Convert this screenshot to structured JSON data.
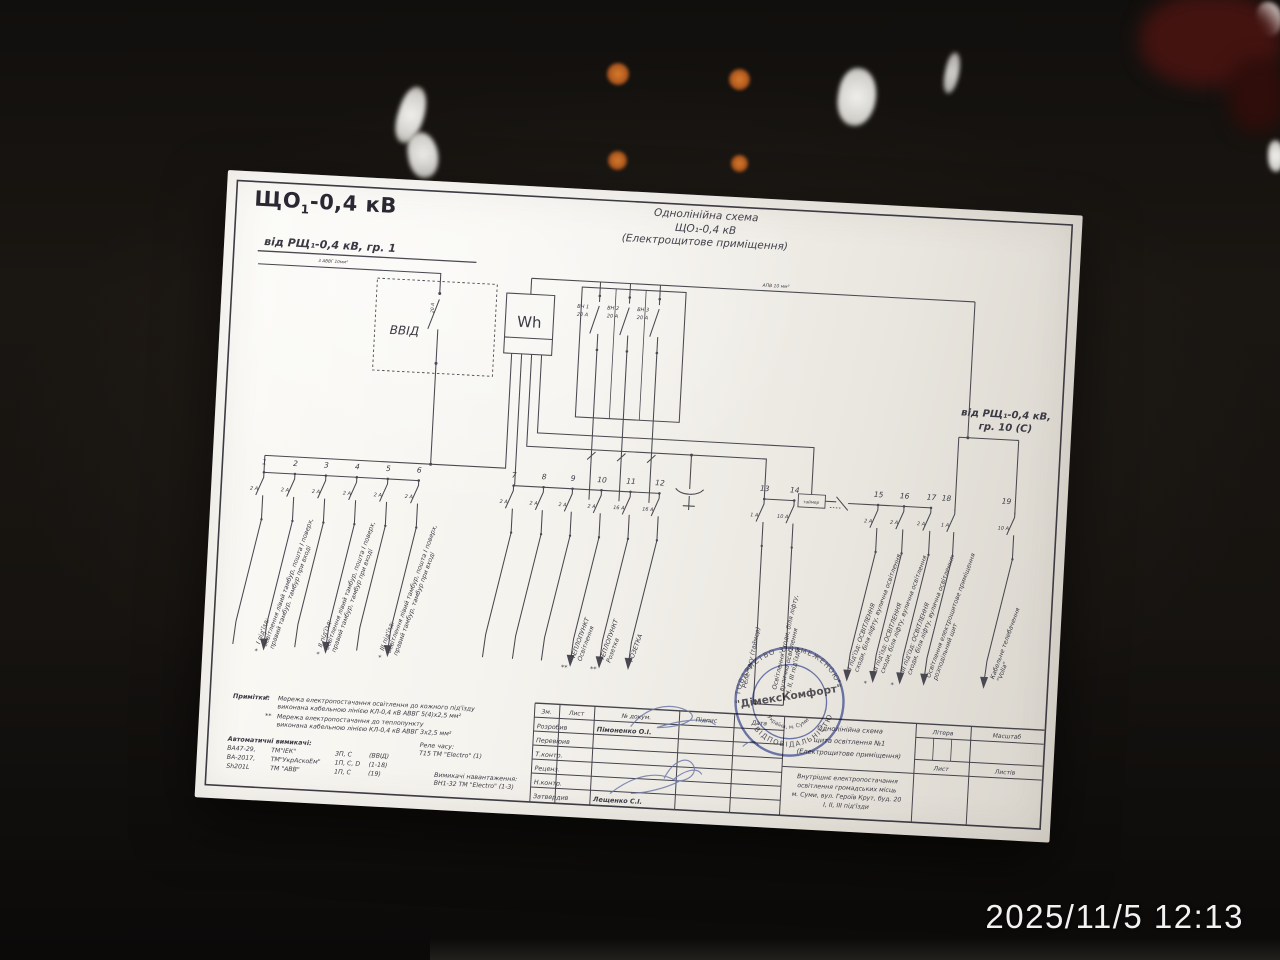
{
  "photo": {
    "timestamp": "2025/11/5 12:13"
  },
  "doc": {
    "board_title": {
      "prefix": "ЩО",
      "sub": "1",
      "suffix": "-0,4 кВ"
    },
    "scheme_title": [
      "Однолінійна схема",
      "ЩО₁-0,4 кВ",
      "(Електрощитове приміщення)"
    ],
    "feed_left": {
      "label": "від РЩ₁-0,4 кВ, гр. 1",
      "cable": "3 АВВГ 10мм²"
    },
    "feed_right": [
      "від РЩ₁-0,4 кВ,",
      "гр. 10 (С)"
    ],
    "vvid": {
      "label": "ВВІД",
      "rating": "20 А"
    },
    "meter": "Wh",
    "bus_note": "АПВ 10 мм²",
    "relay_box": "таймер",
    "vn": [
      {
        "name": "ВН 1",
        "amp": "20 А"
      },
      {
        "name": "ВН 2",
        "amp": "20 А"
      },
      {
        "name": "ВН 3",
        "amp": "20 А"
      }
    ],
    "circuits": [
      {
        "n": "1",
        "amp": "2 А",
        "label": "",
        "marker": ""
      },
      {
        "n": "2",
        "amp": "2 А",
        "label": "І під'їзд:\nосвітлення лівий тамбур, пошта І поверх,\nправий тамбур, тамбур при вході",
        "marker": "*"
      },
      {
        "n": "3",
        "amp": "2 А",
        "label": "",
        "marker": ""
      },
      {
        "n": "4",
        "amp": "2 А",
        "label": "ІІ під'їзд:\nосвітлення лівий тамбур, пошта І поверх,\nправий тамбур, тамбур при вході",
        "marker": "*"
      },
      {
        "n": "5",
        "amp": "2 А",
        "label": "",
        "marker": ""
      },
      {
        "n": "6",
        "amp": "2 А",
        "label": "ІІІ під'їзд:\nосвітлення лівий тамбур, пошта І поверх,\nправий тамбур, тамбур при вході",
        "marker": "*"
      },
      {
        "n": "7",
        "amp": "2 А",
        "label": "",
        "marker": ""
      },
      {
        "n": "8",
        "amp": "2 А",
        "label": "",
        "marker": ""
      },
      {
        "n": "9",
        "amp": "2 А",
        "label": "",
        "marker": ""
      },
      {
        "n": "10",
        "amp": "2 А",
        "label": "ТЕПЛОПУНКТ\nОсвітлення",
        "marker": "**"
      },
      {
        "n": "11",
        "amp": "16 А",
        "label": "ТЕПЛОПУНКТ\nРозетка",
        "marker": "**"
      },
      {
        "n": "12",
        "amp": "16 А",
        "label": "РОЗЕТКА",
        "marker": ""
      },
      {
        "n": "13",
        "amp": "1 А",
        "label": "Реле часу (таймер)",
        "marker": ""
      },
      {
        "n": "14",
        "amp": "10 А",
        "label": "Освітлення сходи, біля ліфту,\nвулична освітлення\nІ, ІІ, ІІІ під'їзди",
        "marker": ""
      },
      {
        "n": "15",
        "amp": "2 А",
        "label": "І під'їзд: ОСВІТЛЕННЯ\nсходи, біля ліфту, вулична освітлення",
        "marker": "*"
      },
      {
        "n": "16",
        "amp": "2 А",
        "label": "ІІ під'їзд: ОСВІТЛЕННЯ\nсходи, біля ліфту, вулична освітлення",
        "marker": "*"
      },
      {
        "n": "17",
        "amp": "2 А",
        "label": "ІІІ під'їзд: ОСВІТЛЕННЯ\nсходи, біля ліфту, вулична освітлення",
        "marker": "*"
      },
      {
        "n": "18",
        "amp": "1 А",
        "label": "Освітлення електрощитове приміщення\nрозподільний щит",
        "marker": ""
      },
      {
        "n": "19",
        "amp": "10 А",
        "label": "Кабельне телебачення\n\"Volia\"",
        "marker": ""
      }
    ]
  },
  "titleblock": {
    "header": [
      "Зм.",
      "Лист",
      "№ докум.",
      "Підпис",
      "Дата"
    ],
    "rows": [
      "Розробив",
      "Перевірив",
      "Т.контр.",
      "Реценз.",
      "Н.контр.",
      "Затвердив"
    ],
    "names": {
      "developer": "Пімоненко О.І.",
      "approver": "Лещенко С.І."
    },
    "project": [
      "Однолінійна схема",
      "щита освітлення №1",
      "(Електрощитове приміщення)"
    ],
    "description": [
      "Внутрішнє електропостачання",
      "освітлення громадських місць",
      "м. Суми, вул. Героїв Крут, буд. 20",
      "І, ІІ, ІІІ під'їзди"
    ],
    "litera": "Літера",
    "scale": "Масштаб",
    "sheet": "Лист",
    "sheets": "Листів"
  },
  "notes": {
    "title": "Примітки:",
    "items": [
      {
        "marker": "*",
        "lines": [
          "Мережа електропостачання освітлення до кожного під'їзду",
          "виконана кабельною лінією КЛ-0,4 кВ    АВВГ 5(4)х2,5 мм²"
        ]
      },
      {
        "marker": "**",
        "lines": [
          "Мережа електропостачання до теплопункту",
          "виконана кабельною лінією КЛ-0,4 кВ    АВВГ 3х2,5 мм²"
        ]
      }
    ],
    "breakers_title": "Автоматичні вимикачі:",
    "breakers": [
      [
        "ВА47-29,",
        "ТМ\"ІЕК\"",
        "3П, С",
        "(ВВІД)"
      ],
      [
        "ВА-2017,",
        "ТМ\"УкрАскоЕм\"",
        "1П, С, D",
        "(1-18)"
      ],
      [
        "Sh201L",
        "ТМ \"АВВ\"",
        "1П, С",
        "(19)"
      ]
    ],
    "relay": {
      "title": "Реле часу:",
      "value": "Т15 ТМ \"Electro\" (1)"
    },
    "load_switches": {
      "title": "Вимикачі навантаження:",
      "value": "ВН1-32 ТМ \"Electro\" (1-3)"
    }
  },
  "stamp": {
    "arc_top": "ТОВАРИСТВО З ОБМЕЖЕНОЮ",
    "arc_mid": "ВІДПОВІДАЛЬНІСТЮ",
    "company": "\"ДімексКомфорт\"",
    "arc_bottom": "Україна, м. Суми"
  }
}
